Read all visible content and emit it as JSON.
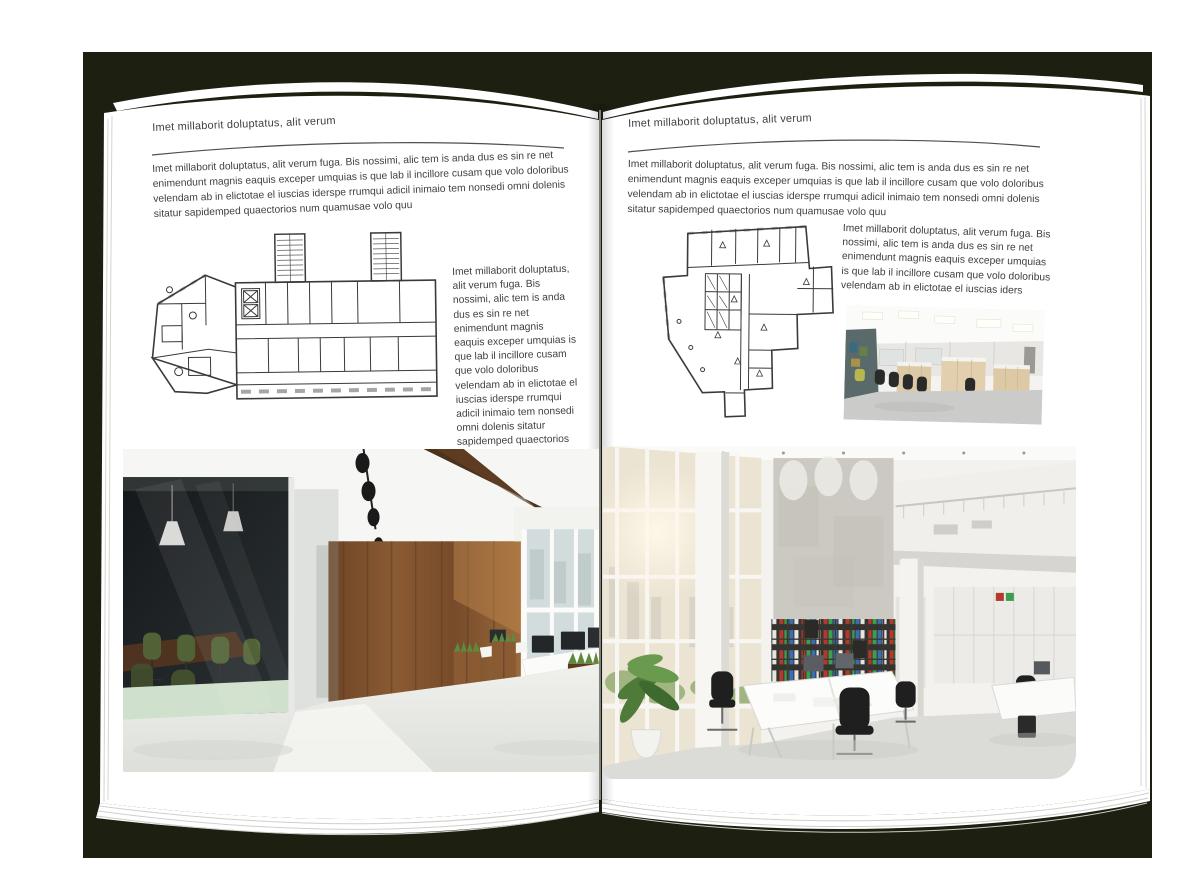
{
  "colors": {
    "canvas": "#ffffff",
    "backdrop": "#1d1f10",
    "page": "#ffffff",
    "text": "#3f3f3f",
    "rule": "#4f4f4f",
    "plan_line": "#3a3a3a",
    "wood_dark": "#5d3c22",
    "wood_mid": "#8a5a33",
    "chair_green": "#516336",
    "chair_black": "#1f1f1f",
    "window_glass": "#d3dcdd",
    "concrete": "#ccc9c2",
    "binder_red": "#b5382e",
    "binder_green": "#3f9e4d",
    "binder_blue": "#3c6cb4",
    "plant_green": "#5d8a3c",
    "wood_light": "#ddc9a6",
    "floor_light": "#e9eae6"
  },
  "left_page": {
    "header": "Imet millaborit doluptatus, alit verum",
    "intro": "Imet millaborit doluptatus, alit verum fuga. Bis nossimi, alic tem is anda dus es sin re net enimendunt magnis eaquis exceper umquias is que lab il incillore cusam que volo doloribus velendam ab in elictotae el iuscias iderspe rrumqui adicil inimaio tem nonsedi omni dolenis sitatur sapidemped quaectorios num quamusae volo quu",
    "side_text": "Imet millaborit doluptatus, alit verum fuga. Bis nossimi, alic tem is anda dus es sin re net enimendunt magnis eaquis exceper umquias is que lab il incillore cusam que volo doloribus velendam ab in elictotae el iuscias iderspe rrumqui adicil inimaio tem nonsedi omni dolenis sitatur sapidemped quaectorios num quamusae volo quu",
    "floor_plan_alt": "architectural floor plan drawing",
    "photo_alt": "loft office interior with glass meeting room, green chairs and wood wall"
  },
  "right_page": {
    "header": "Imet millaborit doluptatus, alit verum",
    "intro": "Imet millaborit doluptatus, alit verum fuga. Bis nossimi, alic tem is anda dus es sin re net enimendunt magnis eaquis exceper umquias is que lab il incillore cusam que volo doloribus velendam ab in elictotae el iuscias iderspe rrumqui adicil inimaio tem nonsedi omni dolenis sitatur sapidemped quaectorios num quamusae volo quu",
    "side_text": "Imet millaborit doluptatus, alit verum fuga. Bis nossimi, alic tem is anda dus es sin re net enimendunt magnis eaquis exceper umquias is que lab il incillore cusam que volo doloribus velendam ab in elictotae el iuscias iders",
    "floor_plan_alt": "architectural floor plan drawing",
    "photo_small_alt": "open plan office with wood cabinets and black chairs",
    "photo_alt": "bright double-height office with bookshelves and white desks"
  }
}
